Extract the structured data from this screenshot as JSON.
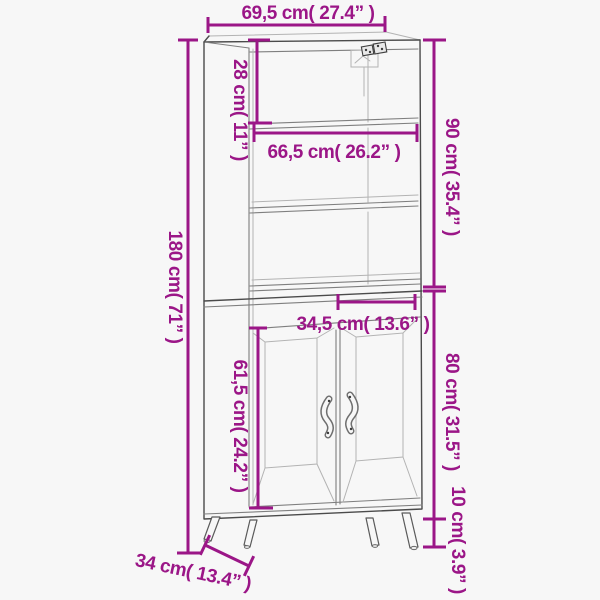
{
  "diagram": {
    "type": "product-dimension-diagram",
    "subject": "tall cabinet with open shelves and two doors"
  },
  "colors": {
    "dimension_accent": "#9b1687",
    "outline_dark": "#4b4b4b",
    "outline_mid": "#7f7f7f",
    "outline_light": "#b3b3b3",
    "background": "#f7f7f7"
  },
  "icons": {
    "wall_bracket": "wall-mount-bracket-icon",
    "door_handle": "door-handle-icon"
  },
  "dimensions": {
    "total_width": {
      "label": "69,5 cm( 27.4” )",
      "cm": "69,5",
      "inches": "27.4"
    },
    "top_section_height": {
      "label": "28 cm( 11” )",
      "cm": "28",
      "inches": "11"
    },
    "upper_unit_height": {
      "label": "90 cm( 35.4” )",
      "cm": "90",
      "inches": "35.4"
    },
    "inner_width": {
      "label": "66,5 cm( 26.2” )",
      "cm": "66,5",
      "inches": "26.2"
    },
    "full_height": {
      "label": "180 cm( 71” )",
      "cm": "180",
      "inches": "71"
    },
    "door_section_width": {
      "label": "34,5 cm( 13.6” )",
      "cm": "34,5",
      "inches": "13.6"
    },
    "door_height": {
      "label": "61,5 cm( 24.2” )",
      "cm": "61,5",
      "inches": "24.2"
    },
    "lower_unit_height": {
      "label": "80 cm( 31.5” )",
      "cm": "80",
      "inches": "31.5"
    },
    "leg_height": {
      "label": "10 cm( 3.9” )",
      "cm": "10",
      "inches": "3.9"
    },
    "depth": {
      "label": "34 cm( 13.4” )",
      "cm": "34",
      "inches": "13.4"
    }
  }
}
